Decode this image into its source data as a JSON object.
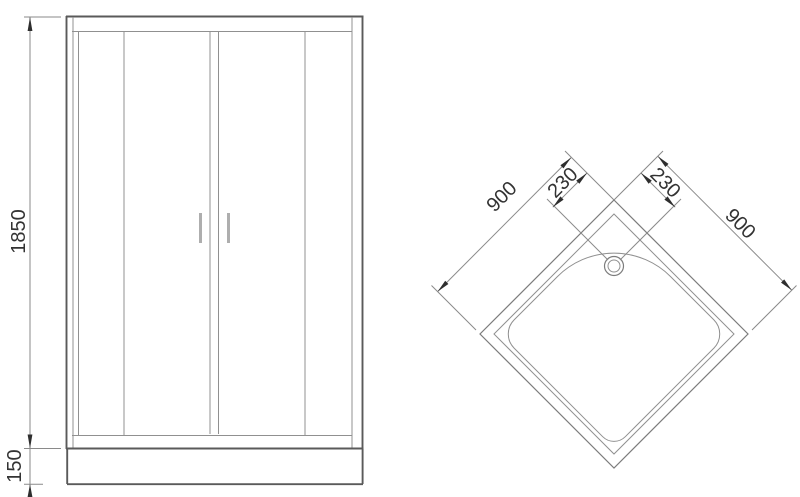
{
  "front_view": {
    "height_mm": "1850",
    "tray_height_mm": "150"
  },
  "plan_view": {
    "side_left_mm": "900",
    "side_right_mm": "900",
    "drain_offset_left_mm": "230",
    "drain_offset_right_mm": "230"
  },
  "colors": {
    "background": "#ffffff",
    "line": "#8f8f8f",
    "frame_line": "#5a5a5a",
    "text": "#333333",
    "arrow": "#2e2e2e"
  }
}
